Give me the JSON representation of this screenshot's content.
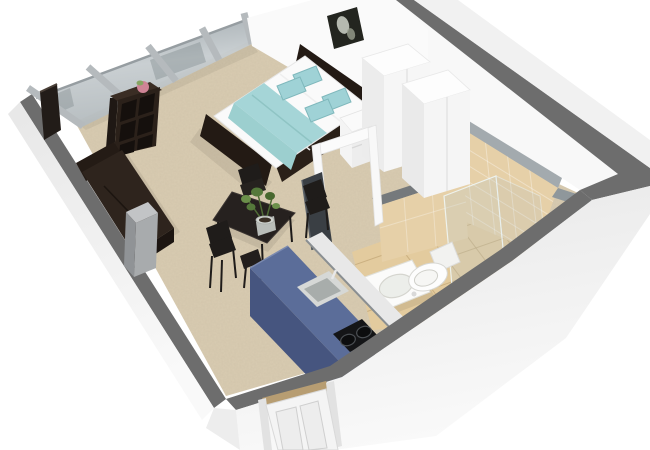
{
  "scene": {
    "type": "3d-floorplan-render",
    "style": "isometric-cutaway",
    "subject": "studio-apartment",
    "background": "#ffffff"
  },
  "colors": {
    "wall_cut": "#6d6d6d",
    "wall_outer": "#efefef",
    "wall_inner": "#fafafa",
    "glass": "#b7bfc3",
    "carpet": "#d9ccb2",
    "tile_floor": "#e3cb9e",
    "tile_wall": "#e6d0a8",
    "ledge": "#a3aaae",
    "wood_dark": "#2b211a",
    "sofa": "#2e241d",
    "table": "#26211f",
    "counter_top": "#5b6d99",
    "counter_side": "#46557f",
    "counter_end": "#3f4c72",
    "bed_frame": "#231a14",
    "mattress": "#fafafa",
    "bed_accent": "#a5d5d7",
    "pillow": "#9fd2d6",
    "wardrobe": "#f6f6f6",
    "nightstand": "#ededed",
    "door": "#f4f4f4",
    "door_panel_dark": "#3a3f44",
    "threshold": "#b79d72",
    "hob": "#141517",
    "sink_steel": "#a8adab",
    "fixture": "#fbfbfa",
    "plant": "#55793b",
    "stand_gray": "#a8abad",
    "artwork_bg": "#23251f"
  },
  "rooms": [
    {
      "name": "living-sleeping-area",
      "floor": "carpet"
    },
    {
      "name": "kitchenette",
      "floor": "carpet"
    },
    {
      "name": "bathroom",
      "floor": "tile"
    },
    {
      "name": "entry",
      "floor": "carpet"
    }
  ],
  "furniture": [
    "glass-window-wall",
    "wall-tv-panel",
    "cube-shelf",
    "decor-ball",
    "sofa",
    "side-stand",
    "double-bed",
    "bed-pillows",
    "bed-throw",
    "headboard",
    "wall-artwork",
    "nightstand",
    "wardrobe",
    "bathroom-door-frame",
    "dining-table",
    "dining-chairs",
    "potted-plant",
    "kitchen-counter",
    "kitchen-sink",
    "cooktop",
    "partition-walls",
    "shower-glass",
    "washbasin",
    "toilet",
    "entry-door"
  ]
}
